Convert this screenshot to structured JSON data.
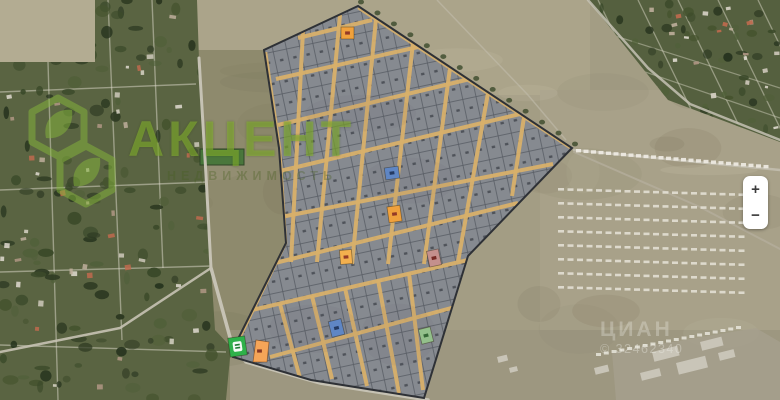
{
  "controls": {
    "zoom_in": "+",
    "zoom_out": "−"
  },
  "watermarks": {
    "logo": {
      "title": "АКЦЕНТ",
      "subtitle": "НЕДВИЖИМОСТЬ",
      "color": "#8bc53f"
    },
    "photo_stamp": {
      "brand": "ЦИАН",
      "id_text": "© 32462340"
    }
  },
  "map": {
    "palette": {
      "field": "#a39d84",
      "village": "#5a6442",
      "village_ne": "#55603f",
      "road": "#c6c2b4",
      "street": "#d8b06a",
      "plot_fill": "#868a90",
      "plot_line": "#4b4f57",
      "boundary": "#2e3136"
    },
    "markers": [
      {
        "id": "plot-marker-orange-top",
        "x": 341,
        "y": 27,
        "w": 13,
        "h": 12,
        "rot": 0,
        "fill": "#f0a13c",
        "glyph": "#8a2f23"
      },
      {
        "id": "plot-marker-blue-upper",
        "x": 385,
        "y": 167,
        "w": 14,
        "h": 12,
        "rot": -8,
        "fill": "#5f86c4",
        "glyph": "#1e3258"
      },
      {
        "id": "plot-marker-orange-mid",
        "x": 388,
        "y": 206,
        "w": 13,
        "h": 16,
        "rot": -8,
        "fill": "#f0a13c",
        "glyph": "#8a2f23"
      },
      {
        "id": "plot-marker-orange-lower",
        "x": 340,
        "y": 250,
        "w": 12,
        "h": 14,
        "rot": -5,
        "fill": "#f3b04e",
        "glyph": "#8a2f23"
      },
      {
        "id": "plot-marker-red",
        "x": 428,
        "y": 250,
        "w": 12,
        "h": 16,
        "rot": -12,
        "fill": "#c4908d",
        "glyph": "#6e1f1a"
      },
      {
        "id": "plot-marker-blue-lower",
        "x": 330,
        "y": 320,
        "w": 13,
        "h": 16,
        "rot": -14,
        "fill": "#5f86c4",
        "glyph": "#1e3258"
      },
      {
        "id": "plot-marker-green-right",
        "x": 420,
        "y": 328,
        "w": 12,
        "h": 15,
        "rot": -14,
        "fill": "#93c08b",
        "glyph": "#2c5e2e"
      },
      {
        "id": "plot-marker-green-badge",
        "x": 229,
        "y": 337,
        "w": 17,
        "h": 19,
        "rot": -8,
        "fill": "#2eb14a",
        "glyph": "#1d7a32",
        "icon": "badge"
      },
      {
        "id": "plot-marker-orange-wedge",
        "x": 250,
        "y": 340,
        "w": 19,
        "h": 22,
        "rot": 0,
        "fill": "#f5a558",
        "glyph": "#7a2b1e",
        "icon": "wedge"
      }
    ]
  }
}
